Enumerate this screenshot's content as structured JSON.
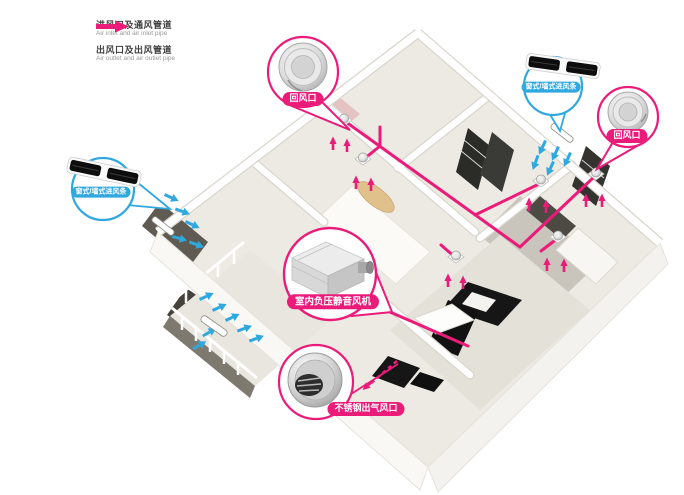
{
  "diagram": {
    "type": "home-ventilation-system-isometric-floorplan",
    "duct_color": "#EB1C79",
    "inlet_arrow_color": "#2FA8DF",
    "outlet_arrow_color": "#EB1C79"
  },
  "legend": {
    "items": [
      {
        "id": "air-inlet",
        "label_cn": "进风口及通风管道",
        "label_en": "Air inlet and air inlet pipe",
        "color": "#2FA8DF"
      },
      {
        "id": "air-outlet",
        "label_cn": "出风口及出风管道",
        "label_en": "Air outlet and air outlet pipe",
        "color": "#EB1C79"
      }
    ]
  },
  "callouts": [
    {
      "id": "return-air-vent-top",
      "label": "回风口",
      "device": "round-return-air-vent",
      "color": "#EB1C79"
    },
    {
      "id": "window-inlet-right",
      "label": "窗式/墙式进风条",
      "device": "slatted-air-inlet-strip",
      "color": "#2FA8DF"
    },
    {
      "id": "return-air-vent-right",
      "label": "回风口",
      "device": "round-return-air-vent",
      "color": "#EB1C79"
    },
    {
      "id": "window-inlet-left",
      "label": "窗式/墙式进风条",
      "device": "slatted-air-inlet-strip",
      "color": "#2FA8DF"
    },
    {
      "id": "indoor-silent-fan",
      "label": "室内负压静音风机",
      "device": "inline-duct-fan-unit",
      "color": "#EB1C79"
    },
    {
      "id": "stainless-outlet-vent",
      "label": "不锈钢出气风口",
      "device": "stainless-steel-air-outlet",
      "color": "#EB1C79"
    }
  ]
}
